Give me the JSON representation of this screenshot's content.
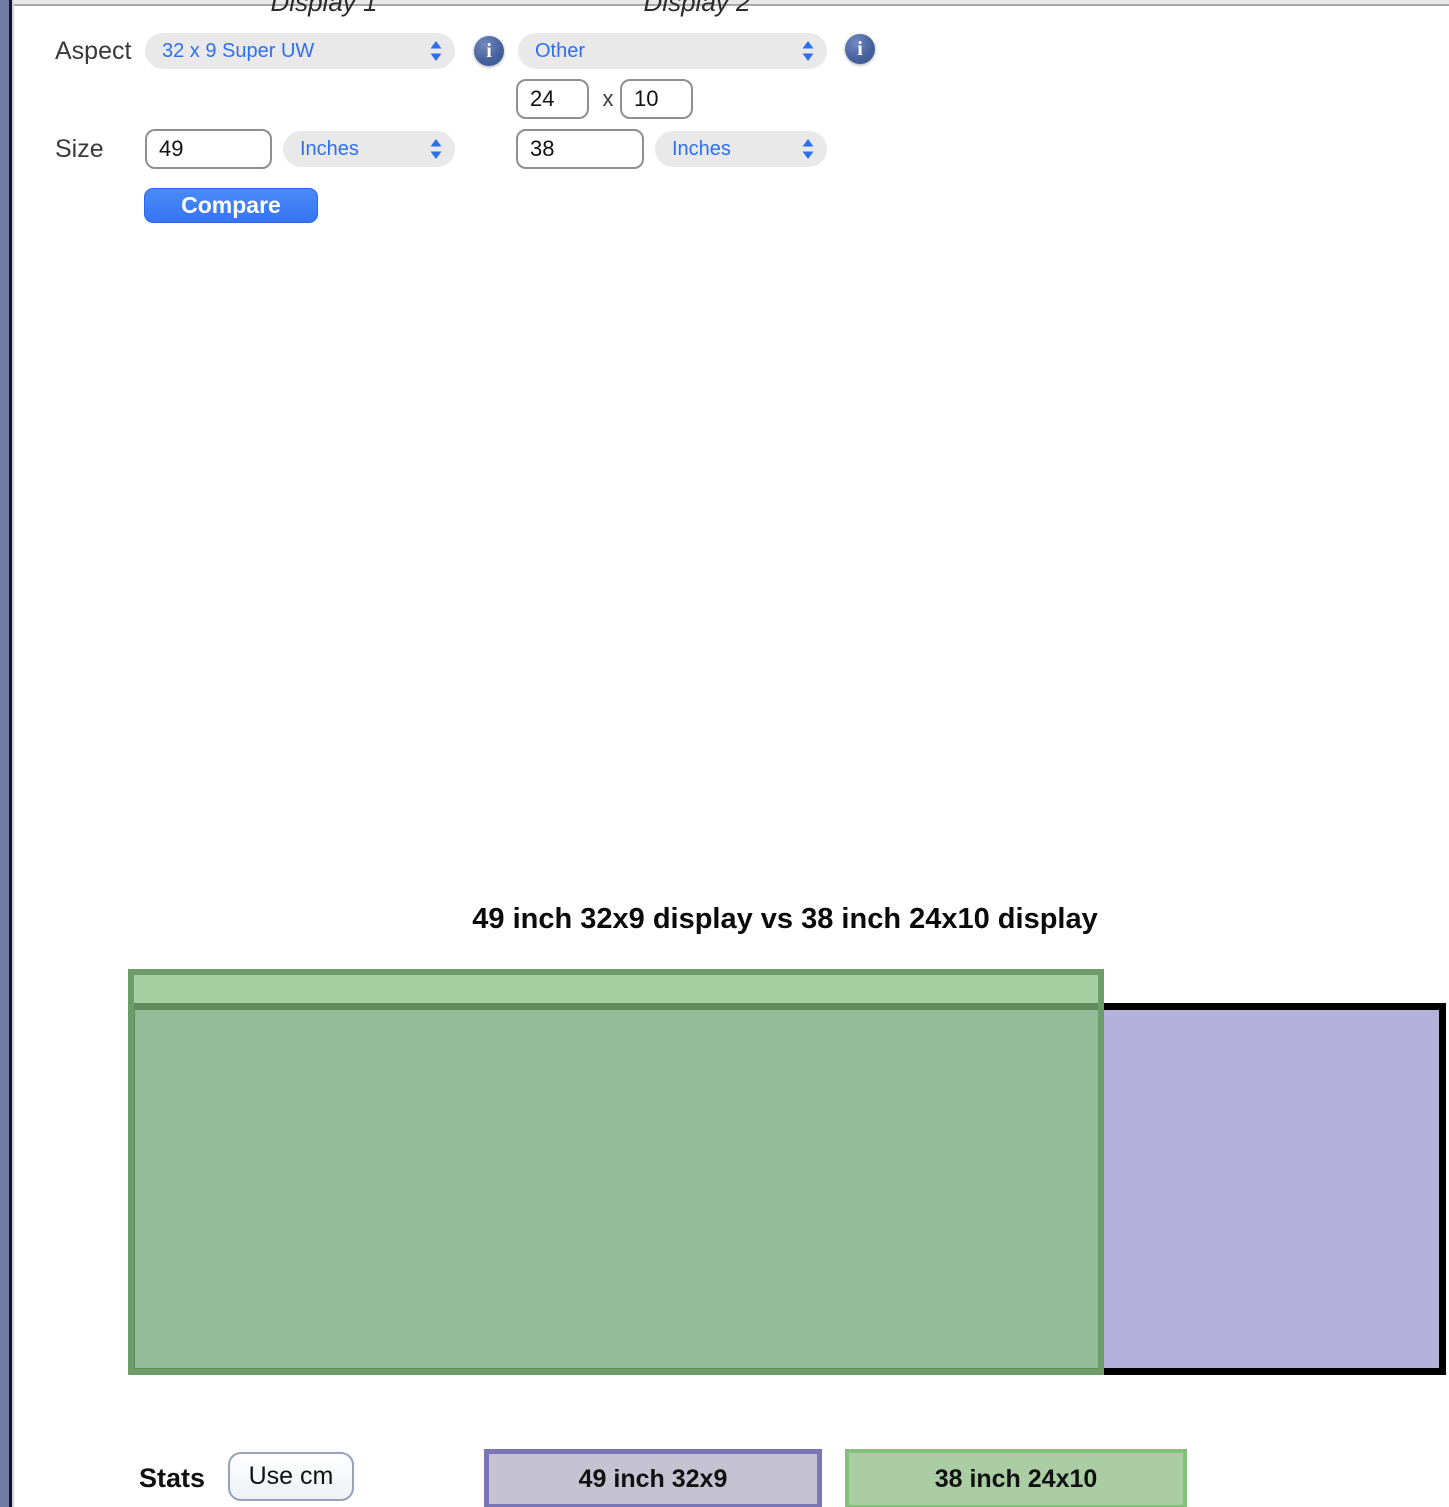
{
  "columns": {
    "display1_header": "Display 1",
    "display2_header": "Display 2"
  },
  "form": {
    "aspect_label": "Aspect",
    "size_label": "Size",
    "dimension_separator": "x",
    "compare_button": "Compare",
    "display1": {
      "aspect": "32 x 9 Super UW",
      "size": "49",
      "unit": "Inches"
    },
    "display2": {
      "aspect": "Other",
      "width": "24",
      "height": "10",
      "size": "38",
      "unit": "Inches"
    }
  },
  "icons": {
    "info_glyph": "i",
    "select_chevron": "up-down-chevrons"
  },
  "comparison": {
    "title": "49 inch 32x9 display vs 38 inch 24x10 display",
    "display1_label": "49 inch 32x9",
    "display2_label": "38 inch 24x10"
  },
  "stats": {
    "label": "Stats",
    "unit_toggle_button": "Use cm"
  },
  "colors": {
    "accent_blue": "#2e6ff2",
    "compare_button_blue": "#3b7bf5",
    "select_pill_gray": "#e9e9ea",
    "info_icon_blue": "#47639f",
    "display1_fill": "#b4b2db",
    "display1_border": "#000000",
    "display2_fill": "#a7d0a3",
    "display2_border": "#6d9c68",
    "badge1_fill": "#c5c2d2",
    "badge1_border": "#7a75b4",
    "badge2_fill": "#abcda4",
    "badge2_border": "#86c07d",
    "window_edge": "#6f7da5"
  }
}
